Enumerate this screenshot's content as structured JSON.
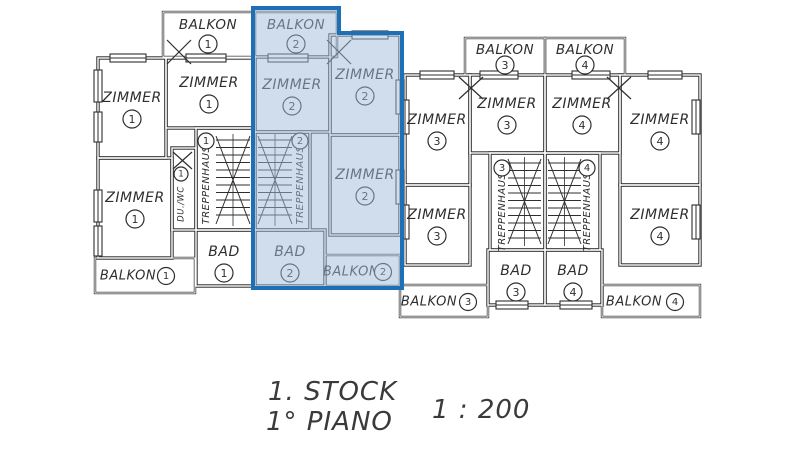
{
  "plan": {
    "labels": {
      "balkon": "BALKON",
      "zimmer": "ZIMMER",
      "bad": "BAD",
      "treppenhaus": "TREPPENHAUS",
      "du_wc": "DU./WC"
    },
    "units": [
      {
        "number": "1"
      },
      {
        "number": "2"
      },
      {
        "number": "3"
      },
      {
        "number": "4"
      }
    ],
    "highlight": {
      "selected_unit": "2",
      "overlay_fill": "rgba(160,188,218,0.5)",
      "border": "#1e70b6"
    }
  },
  "footer": {
    "floor_de": "1. STOCK",
    "floor_it": "1° PIANO",
    "scale": "1 : 200"
  }
}
